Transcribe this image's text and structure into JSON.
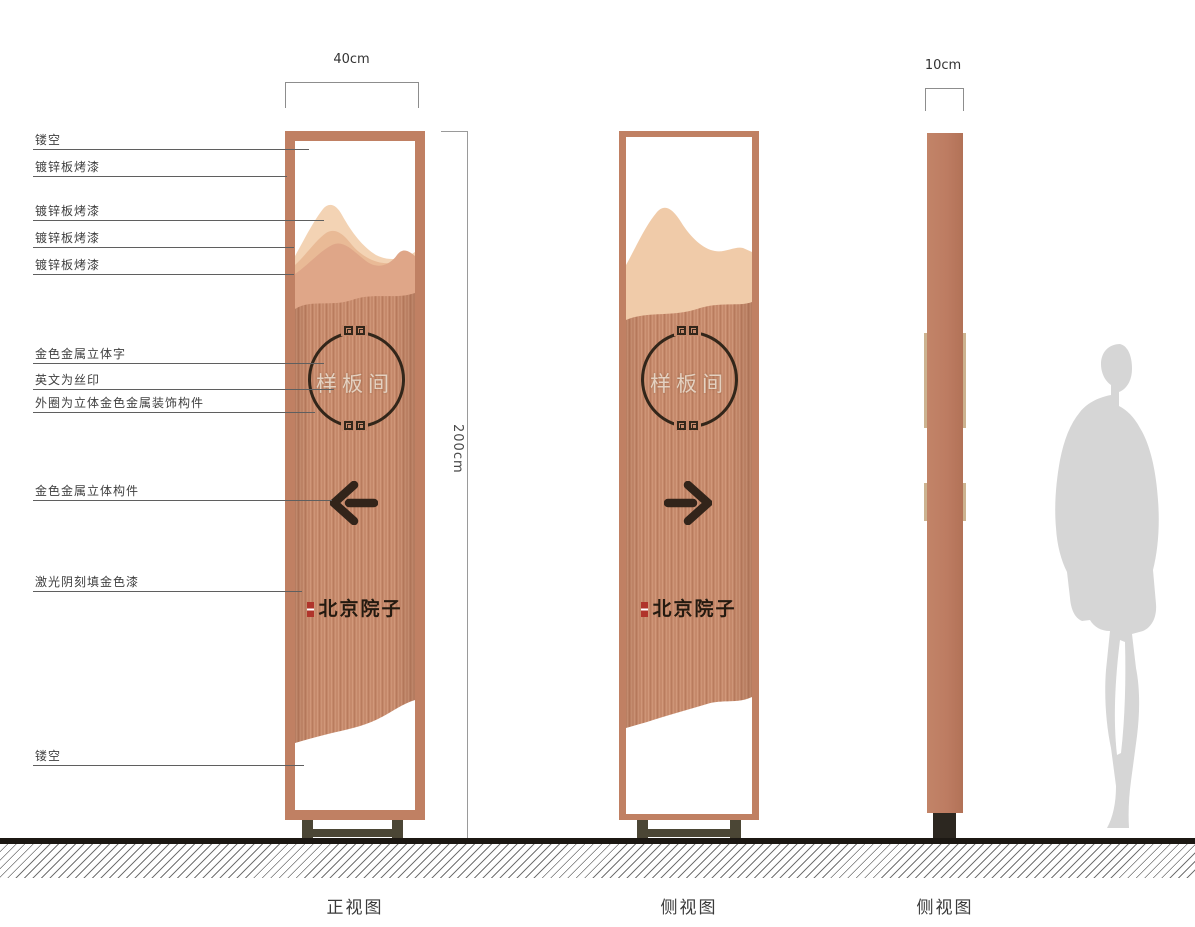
{
  "callouts": [
    {
      "label": "镂空"
    },
    {
      "label": "镀锌板烤漆"
    },
    {
      "label": "镀锌板烤漆"
    },
    {
      "label": "镀锌板烤漆"
    },
    {
      "label": "镀锌板烤漆"
    },
    {
      "label": "金色金属立体字"
    },
    {
      "label": "英文为丝印"
    },
    {
      "label": "外圈为立体金色金属装饰构件"
    },
    {
      "label": "金色金属立体构件"
    },
    {
      "label": "激光阴刻填金色漆"
    },
    {
      "label": "镂空"
    }
  ],
  "dimensions": {
    "front_width": "40cm",
    "height": "200cm",
    "side_width": "10cm"
  },
  "emblem": {
    "plaque_text": "样板间"
  },
  "brand": {
    "text": "北京院子"
  },
  "views": [
    {
      "label": "正视图"
    },
    {
      "label": "侧视图"
    },
    {
      "label": "侧视图"
    }
  ],
  "icons": {
    "front_arrow": "arrow-left",
    "back_arrow": "arrow-right",
    "circle_ornament": "greek-key-meander",
    "brand_seal": "red-seal-stamp",
    "scale_figure": "human-silhouette"
  },
  "colors": {
    "frame_copper": "#c08063",
    "panel_brushed_copper": "#c5896b",
    "mountain_light": "#f3d3b4",
    "mountain_mid": "#e9ba96",
    "mountain_dark": "#dfa688",
    "back_mountain": "#f0cba9",
    "base_olive": "#4b4635",
    "side_foot": "#2c2720",
    "ink_dark_brown": "#32261a",
    "seal_red": "#b0342b",
    "silhouette_gray": "#d6d6d6",
    "ground_black": "#1c1813"
  }
}
